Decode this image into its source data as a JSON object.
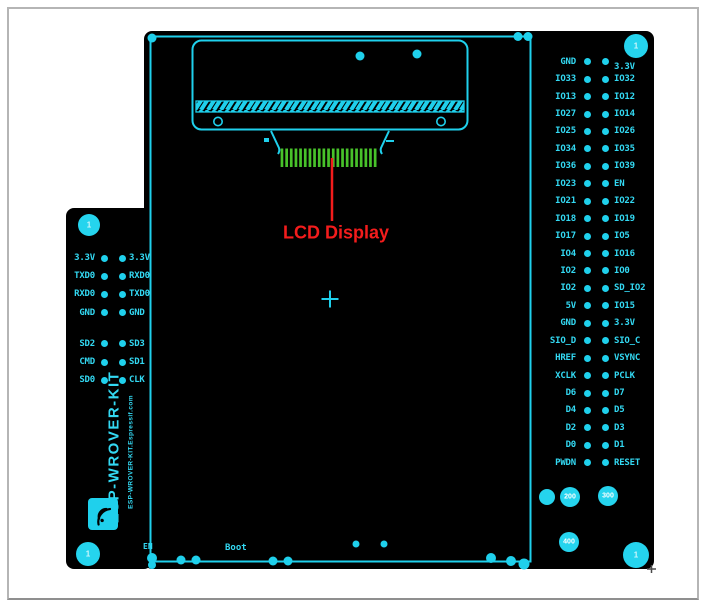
{
  "colors": {
    "cyan": "#1fd0ec",
    "green": "#48c22a",
    "red": "#f31c1c",
    "board": "#000000"
  },
  "annotation": {
    "label": "LCD Display"
  },
  "board": {
    "silkscreen_title": "ESP-WROVER-KIT",
    "silkscreen_subtitle": "ESP-WROVER-KIT.Espressif.com",
    "buttons": {
      "en": "EN",
      "boot": "Boot"
    },
    "hole_markers": {
      "top_left": "1",
      "top_right": "1",
      "bottom_left": "1",
      "bottom_right": "1"
    },
    "drill_sizes": [
      "200",
      "300",
      "400"
    ]
  },
  "pin_headers": {
    "left": {
      "rows": [
        {
          "l": "3.3V",
          "r": "3.3V"
        },
        {
          "l": "TXD0",
          "r": "RXD0"
        },
        {
          "l": "RXD0",
          "r": "TXD0"
        },
        {
          "l": "GND",
          "r": "GND"
        },
        {
          "l": "SD2",
          "r": "SD3"
        },
        {
          "l": "CMD",
          "r": "SD1"
        },
        {
          "l": "SD0",
          "r": "CLK"
        }
      ]
    },
    "right": {
      "rows": [
        {
          "l": "GND",
          "r": "3.3V"
        },
        {
          "l": "IO33",
          "r": "IO32"
        },
        {
          "l": "IO13",
          "r": "IO12"
        },
        {
          "l": "IO27",
          "r": "IO14"
        },
        {
          "l": "IO25",
          "r": "IO26"
        },
        {
          "l": "IO34",
          "r": "IO35"
        },
        {
          "l": "IO36",
          "r": "IO39"
        },
        {
          "l": "IO23",
          "r": "EN"
        },
        {
          "l": "IO21",
          "r": "IO22"
        },
        {
          "l": "IO18",
          "r": "IO19"
        },
        {
          "l": "IO17",
          "r": "IO5"
        },
        {
          "l": "IO4",
          "r": "IO16"
        },
        {
          "l": "IO2",
          "r": "IO0"
        },
        {
          "l": "IO2",
          "r": "SD_IO2"
        },
        {
          "l": "5V",
          "r": "IO15"
        },
        {
          "l": "GND",
          "r": "3.3V"
        },
        {
          "l": "SIO_D",
          "r": "SIO_C"
        },
        {
          "l": "HREF",
          "r": "VSYNC"
        },
        {
          "l": "XCLK",
          "r": "PCLK"
        },
        {
          "l": "D6",
          "r": "D7"
        },
        {
          "l": "D4",
          "r": "D5"
        },
        {
          "l": "D2",
          "r": "D3"
        },
        {
          "l": "D0",
          "r": "D1"
        },
        {
          "l": "PWDN",
          "r": "RESET"
        }
      ]
    }
  }
}
